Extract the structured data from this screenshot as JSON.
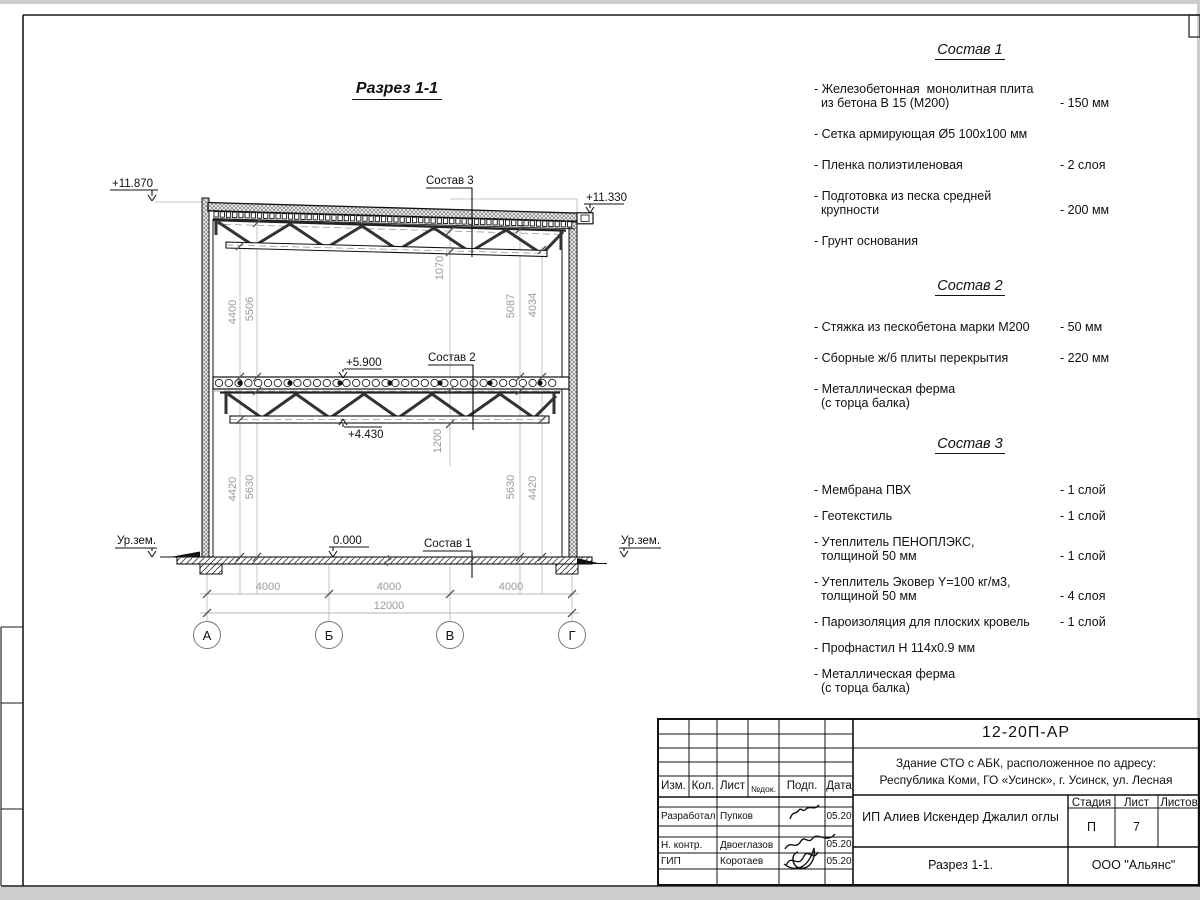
{
  "drawing": {
    "title": "Разрез 1-1",
    "labels": {
      "sostav1": "Состав 1",
      "sostav2": "Состав 2",
      "sostav3": "Состав 3",
      "ground_left": "Ур.зем.",
      "ground_right": "Ур.зем."
    },
    "elevations": {
      "roof_left": "+11.870",
      "roof_right": "+11.330",
      "floor": "+5.900",
      "truss_bottom": "+4.430",
      "zero": "0.000"
    },
    "dims": {
      "left_inner_top": "4400",
      "left_outer_top": "5506",
      "right_inner_top": "5087",
      "right_outer_top": "4034",
      "roof_truss_height": "1070",
      "left_inner_bottom": "4420",
      "left_outer_bottom": "5630",
      "right_inner_bottom": "5630",
      "right_outer_bottom": "4420",
      "floor_truss_height": "1200",
      "spans": [
        "4000",
        "4000",
        "4000"
      ],
      "total": "12000"
    },
    "axes": [
      "А",
      "Б",
      "В",
      "Г"
    ]
  },
  "compositions": [
    {
      "title": "Состав 1",
      "items": [
        {
          "label": "- Железобетонная  монолитная плита\n  из бетона В 15 (М200)",
          "value": "- 150 мм"
        },
        {
          "label": "- Сетка армирующая Ø5 100х100 мм",
          "value": ""
        },
        {
          "label": "- Пленка полиэтиленовая",
          "value": "-  2 слоя"
        },
        {
          "label": "- Подготовка из песка средней\n  крупности",
          "value": "- 200 мм"
        },
        {
          "label": "- Грунт основания",
          "value": ""
        }
      ]
    },
    {
      "title": "Состав 2",
      "items": [
        {
          "label": "- Стяжка из пескобетона марки М200",
          "value": "- 50 мм"
        },
        {
          "label": "- Сборные ж/б плиты перекрытия",
          "value": "- 220 мм"
        },
        {
          "label": "- Металлическая ферма\n  (с торца балка)",
          "value": ""
        }
      ]
    },
    {
      "title": "Состав 3",
      "items": [
        {
          "label": "- Мембрана ПВХ",
          "value": "- 1 слой"
        },
        {
          "label": "- Геотекстиль",
          "value": "- 1 слой"
        },
        {
          "label": "- Утеплитель ПЕНОПЛЭКС,\n  толщиной 50 мм",
          "value": "- 1 слой"
        },
        {
          "label": "- Утеплитель Эковер Y=100 кг/м3,\n  толщиной 50 мм",
          "value": "- 4 слоя"
        },
        {
          "label": "- Пароизоляция для плоских кровель",
          "value": "- 1 слой"
        },
        {
          "label": "- Профнастил Н 114х0.9 мм",
          "value": ""
        },
        {
          "label": "- Металлическая ферма\n  (с торца балка)",
          "value": ""
        }
      ]
    }
  ],
  "title_block": {
    "doc_number": "12-20П-АР",
    "project_line1": "Здание СТО с АБК, расположенное по адресу:",
    "project_line2": "Республика Коми, ГО «Усинск», г. Усинск, ул. Лесная",
    "client": "ИП Алиев Искендер Джалил оглы",
    "sheet_title": "Разрез 1-1.",
    "company": "ООО \"Альянс\"",
    "stage_label": "Стадия",
    "sheet_label": "Лист",
    "sheets_label": "Листов",
    "stage_value": "П",
    "sheet_value": "7",
    "columns": {
      "izm": "Изм.",
      "kol": "Кол.",
      "list": "Лист",
      "ndoc": "№док.",
      "podp": "Подп.",
      "data": "Дата"
    },
    "rows": [
      {
        "role": "Разработал",
        "name": "Пупков",
        "date": "05.20"
      },
      {
        "role": "Н. контр.",
        "name": "Двоеглазов",
        "date": "05.20"
      },
      {
        "role": "ГИП",
        "name": "Коротаев",
        "date": "05.20"
      }
    ]
  }
}
